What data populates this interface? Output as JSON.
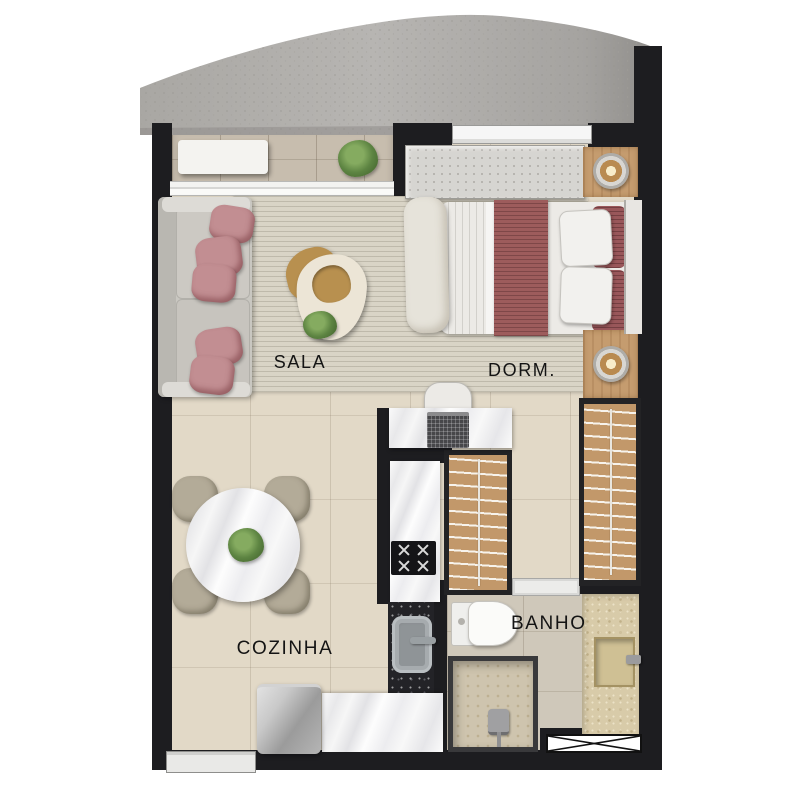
{
  "rooms": {
    "sala": {
      "label": "SALA"
    },
    "dorm": {
      "label": "DORM."
    },
    "cozinha": {
      "label": "COZINHA"
    },
    "banho": {
      "label": "BANHO"
    }
  },
  "palette": {
    "wall": "#1d1d20",
    "concrete_slab": "#b2b0ad",
    "floor_tile": "#e2d9c7",
    "balcony_tile": "#c7bdae",
    "bath_tile": "#cfc8ba",
    "rug": "#d8d3c5",
    "sofa": "#c9c7c1",
    "pillow_pink": "#c28e92",
    "bed_accent": "#9d5c5c",
    "wood": "#c59c6f",
    "marble": "#f1f1f2",
    "granite": "#232327",
    "stone_tan": "#d8cba9",
    "plant_green": "#5d8442"
  }
}
